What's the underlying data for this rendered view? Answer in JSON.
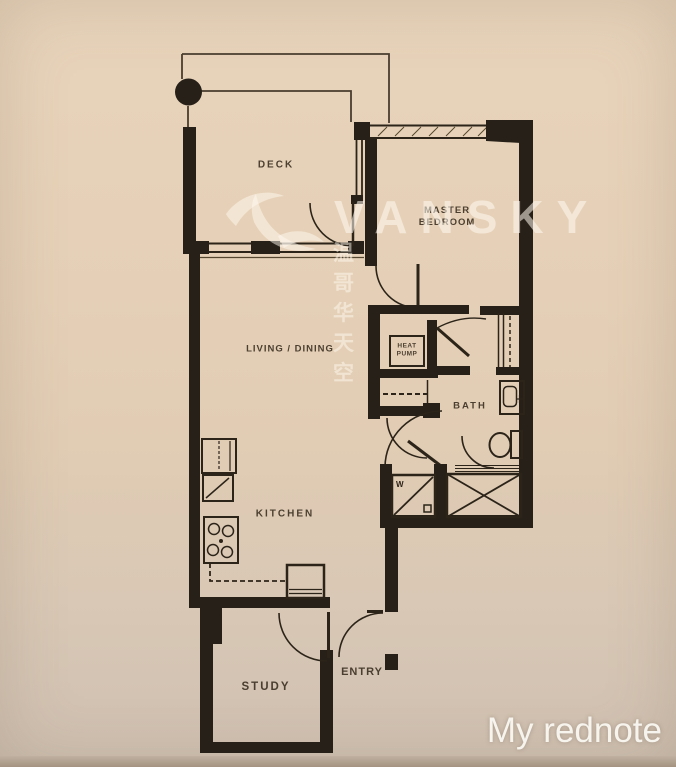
{
  "page": {
    "width": 676,
    "height": 767,
    "type": "floor-plan-photo"
  },
  "colors": {
    "background_top": "#e8d4bb",
    "background_bottom": "#cec0b0",
    "footer_strip": "#ab9c8e",
    "wall": "#262018",
    "thin_line": "#473a2a",
    "label_text": "#372c1e",
    "watermark_white": "#fffaf0",
    "caption_white": "#faf8f2"
  },
  "rooms": {
    "deck": "DECK",
    "living_dining": "LIVING / DINING",
    "master_line1": "MASTER",
    "master_line2": "BEDROOM",
    "heat_pump_line1": "HEAT",
    "heat_pump_line2": "PUMP",
    "bath": "BATH",
    "kitchen": "KITCHEN",
    "study": "STUDY",
    "entry": "ENTRY"
  },
  "fixtures": {
    "washer_label": "W"
  },
  "watermark": {
    "brand": "VANSKY",
    "chinese": "温哥华天空",
    "logo": "swoosh-leaf-icon"
  },
  "caption": "My rednote"
}
